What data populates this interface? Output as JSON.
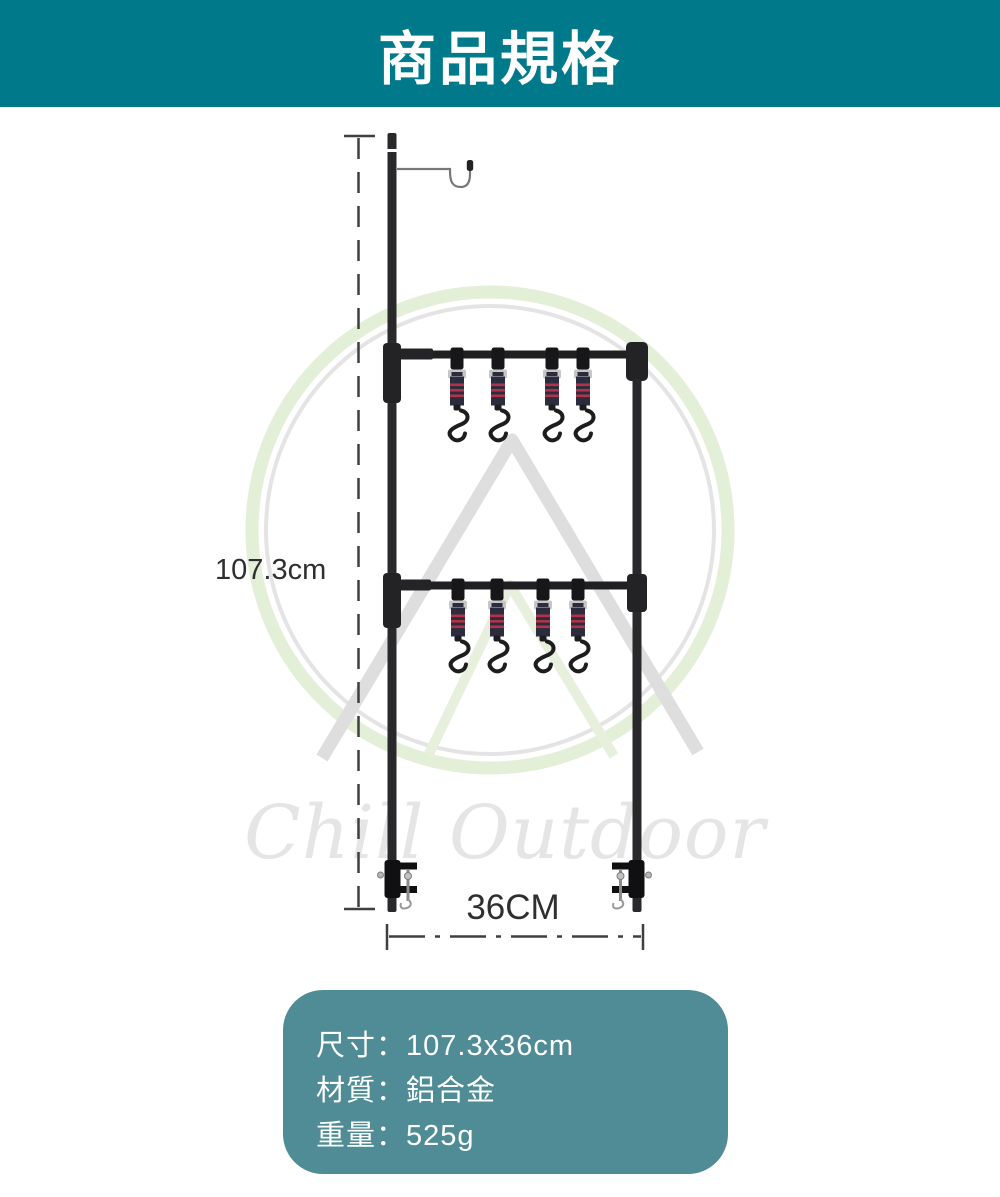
{
  "header": {
    "title": "商品規格"
  },
  "diagram": {
    "height_dimension": "107.3cm",
    "width_dimension": "36CM",
    "watermark_text": "Chill Outdoor",
    "hook_rows": 2,
    "s_hook_count": 8
  },
  "spec_box": {
    "lines": [
      "尺寸：107.3x36cm",
      "材質：鋁合金",
      "重量：525g"
    ]
  },
  "colors": {
    "header_bg": "#00798a",
    "spec_box_bg": "#4f8c96",
    "frame_black": "#232326",
    "strap_navy": "#2b2d3e",
    "strap_red": "#b23247",
    "dimension_gray": "#3f3f3f",
    "watermark_green": "#e3efd7",
    "watermark_gray": "#e4e4e4"
  }
}
